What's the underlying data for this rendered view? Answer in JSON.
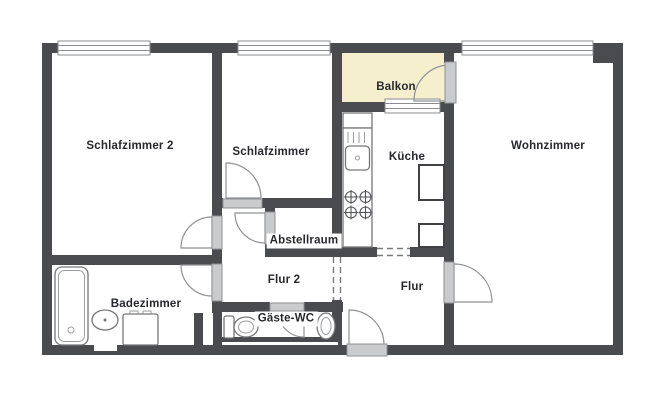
{
  "floorplan": {
    "type": "apartment-floor-plan",
    "rooms": {
      "schlafzimmer2": "Schlafzimmer 2",
      "schlafzimmer": "Schlafzimmer",
      "balkon": "Balkon",
      "kueche": "Küche",
      "wohnzimmer": "Wohnzimmer",
      "abstellraum": "Abstellraum",
      "flur2": "Flur 2",
      "flur": "Flur",
      "badezimmer": "Badezimmer",
      "gaeste_wc": "Gäste-WC"
    },
    "colors": {
      "wall": "#494b4e",
      "balcony_fill": "#f5efce",
      "door_panel": "#c9cbcd",
      "label_text": "#26282b"
    }
  }
}
